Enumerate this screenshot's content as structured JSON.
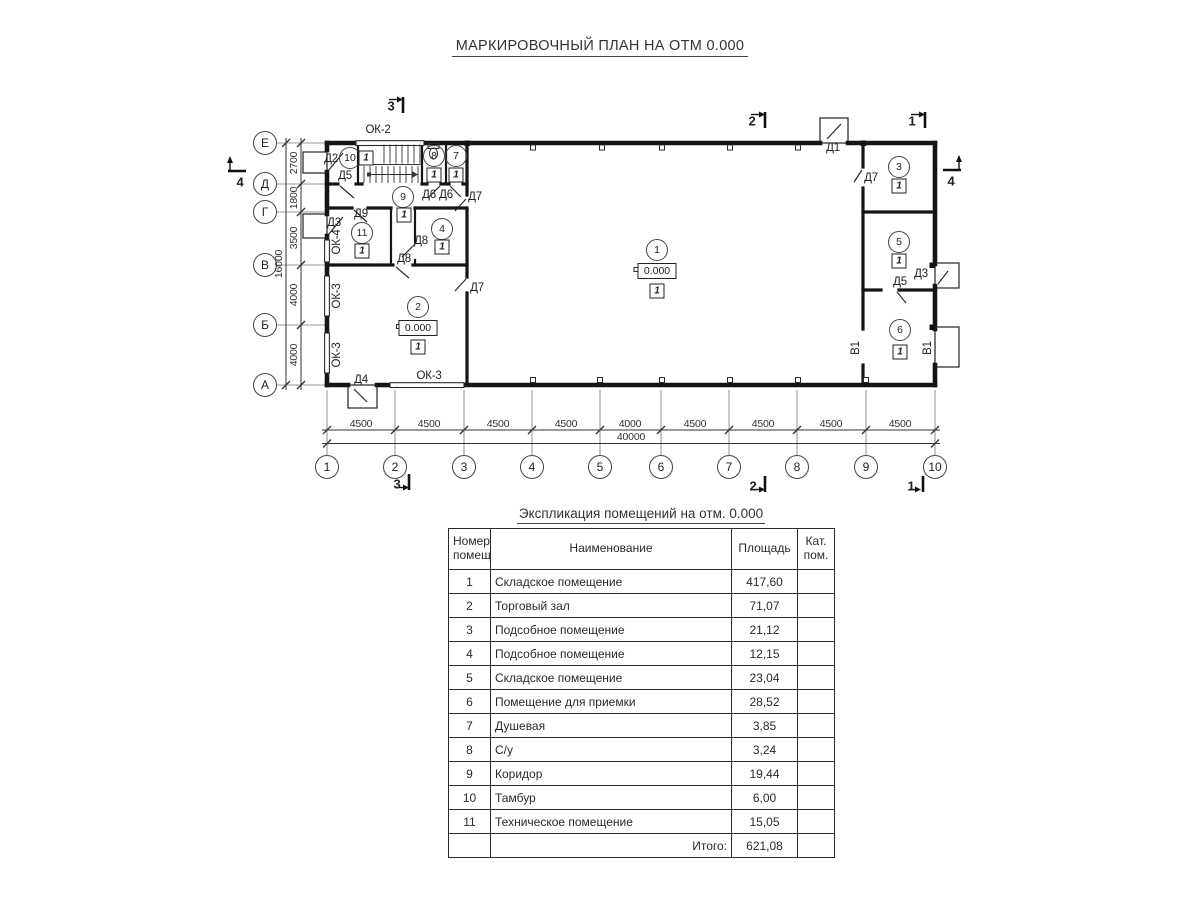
{
  "title": "МАРКИРОВОЧНЫЙ ПЛАН НА ОТМ 0.000",
  "plan": {
    "col_axes": [
      {
        "label": "1",
        "x": 327
      },
      {
        "label": "2",
        "x": 395
      },
      {
        "label": "3",
        "x": 464
      },
      {
        "label": "4",
        "x": 532
      },
      {
        "label": "5",
        "x": 600
      },
      {
        "label": "6",
        "x": 661
      },
      {
        "label": "7",
        "x": 729
      },
      {
        "label": "8",
        "x": 797
      },
      {
        "label": "9",
        "x": 866
      },
      {
        "label": "10",
        "x": 935
      }
    ],
    "row_axes": [
      {
        "label": "Е",
        "y": 143
      },
      {
        "label": "Д",
        "y": 184
      },
      {
        "label": "Г",
        "y": 212
      },
      {
        "label": "В",
        "y": 265
      },
      {
        "label": "Б",
        "y": 325
      },
      {
        "label": "А",
        "y": 385
      }
    ],
    "dims_bottom": [
      {
        "v": "4500",
        "x": 361
      },
      {
        "v": "4500",
        "x": 429
      },
      {
        "v": "4500",
        "x": 498
      },
      {
        "v": "4500",
        "x": 566
      },
      {
        "v": "4000",
        "x": 630
      },
      {
        "v": "4500",
        "x": 695
      },
      {
        "v": "4500",
        "x": 763
      },
      {
        "v": "4500",
        "x": 831
      },
      {
        "v": "4500",
        "x": 900
      }
    ],
    "total_bottom": {
      "v": "40000",
      "x": 631,
      "y": 437
    },
    "dims_left": [
      {
        "v": "2700",
        "y": 163
      },
      {
        "v": "1800",
        "y": 198
      },
      {
        "v": "3500",
        "y": 238
      },
      {
        "v": "4000",
        "y": 295
      },
      {
        "v": "4000",
        "y": 355
      }
    ],
    "total_left": {
      "v": "16000",
      "x": 279,
      "y": 264
    },
    "rooms": [
      {
        "n": "1",
        "cx": 657,
        "cy": 250,
        "elev": "0.000",
        "ex": 657,
        "ey": 271,
        "floor": "1",
        "fx": 657,
        "fy": 291
      },
      {
        "n": "2",
        "cx": 418,
        "cy": 307,
        "elev": "0.000",
        "ex": 418,
        "ey": 328,
        "floor": "1",
        "fx": 418,
        "fy": 347
      },
      {
        "n": "3",
        "cx": 899,
        "cy": 167,
        "floor": "1",
        "fx": 899,
        "fy": 186
      },
      {
        "n": "4",
        "cx": 442,
        "cy": 229,
        "floor": "1",
        "fx": 442,
        "fy": 247
      },
      {
        "n": "5",
        "cx": 899,
        "cy": 242,
        "floor": "1",
        "fx": 899,
        "fy": 261
      },
      {
        "n": "6",
        "cx": 900,
        "cy": 330,
        "floor": "1",
        "fx": 900,
        "fy": 352
      },
      {
        "n": "7",
        "cx": 456,
        "cy": 156,
        "floor": "1",
        "fx": 456,
        "fy": 175
      },
      {
        "n": "8",
        "cx": 434,
        "cy": 156,
        "floor": "1",
        "fx": 434,
        "fy": 175
      },
      {
        "n": "9",
        "cx": 403,
        "cy": 197,
        "floor": "1",
        "fx": 404,
        "fy": 215
      },
      {
        "n": "10",
        "cx": 350,
        "cy": 158,
        "floor": "1",
        "fx": 366,
        "fy": 158
      },
      {
        "n": "11",
        "cx": 362,
        "cy": 233,
        "floor": "1",
        "fx": 362,
        "fy": 251
      }
    ],
    "doors": [
      {
        "id": "Д1",
        "x": 833,
        "y": 148
      },
      {
        "id": "Д2",
        "x": 331,
        "y": 159
      },
      {
        "id": "Д3",
        "x": 334,
        "y": 223
      },
      {
        "id": "Д3",
        "x": 921,
        "y": 274
      },
      {
        "id": "Д4",
        "x": 361,
        "y": 380
      },
      {
        "id": "Д5",
        "x": 345,
        "y": 176
      },
      {
        "id": "Д5",
        "x": 900,
        "y": 282
      },
      {
        "id": "Д6",
        "x": 429,
        "y": 195
      },
      {
        "id": "Д6",
        "x": 446,
        "y": 195
      },
      {
        "id": "Д7",
        "x": 475,
        "y": 197
      },
      {
        "id": "Д7",
        "x": 477,
        "y": 288
      },
      {
        "id": "Д7",
        "x": 871,
        "y": 178
      },
      {
        "id": "Д8",
        "x": 421,
        "y": 241
      },
      {
        "id": "Д8",
        "x": 404,
        "y": 259
      },
      {
        "id": "Д9",
        "x": 361,
        "y": 214
      }
    ],
    "windows": [
      {
        "id": "ОК-2",
        "x": 378,
        "y": 130,
        "rot": 0
      },
      {
        "id": "ОК-4",
        "x": 337,
        "y": 242,
        "rot": 1
      },
      {
        "id": "ОК-3",
        "x": 337,
        "y": 296,
        "rot": 1
      },
      {
        "id": "ОК-3",
        "x": 337,
        "y": 355,
        "rot": 1
      },
      {
        "id": "ОК-3",
        "x": 429,
        "y": 376,
        "rot": 0
      }
    ],
    "gates": [
      {
        "id": "В1",
        "x": 856,
        "y": 348,
        "rot": 1
      },
      {
        "id": "В1",
        "x": 928,
        "y": 348,
        "rot": 1
      }
    ],
    "sections": [
      {
        "n": "3",
        "x": 391,
        "y": 106
      },
      {
        "n": "2",
        "x": 752,
        "y": 121
      },
      {
        "n": "1",
        "x": 912,
        "y": 121
      },
      {
        "n": "4",
        "x": 240,
        "y": 182
      },
      {
        "n": "4",
        "x": 951,
        "y": 181
      },
      {
        "n": "3",
        "x": 397,
        "y": 484
      },
      {
        "n": "2",
        "x": 753,
        "y": 486
      },
      {
        "n": "1",
        "x": 911,
        "y": 486
      }
    ]
  },
  "table": {
    "title": "Экспликация помещений на отм. 0.000",
    "headers": {
      "num": "Номер помещ.",
      "name": "Наименование",
      "area": "Площадь",
      "cat": "Кат. пом."
    },
    "rows": [
      {
        "num": "1",
        "name": "Складское помещение",
        "area": "417,60",
        "cat": ""
      },
      {
        "num": "2",
        "name": "Торговый зал",
        "area": "71,07",
        "cat": ""
      },
      {
        "num": "3",
        "name": "Подсобное помещение",
        "area": "21,12",
        "cat": ""
      },
      {
        "num": "4",
        "name": "Подсобное помещение",
        "area": "12,15",
        "cat": ""
      },
      {
        "num": "5",
        "name": "Складское помещение",
        "area": "23,04",
        "cat": ""
      },
      {
        "num": "6",
        "name": "Помещение для приемки",
        "area": "28,52",
        "cat": ""
      },
      {
        "num": "7",
        "name": "Душевая",
        "area": "3,85",
        "cat": ""
      },
      {
        "num": "8",
        "name": "С/у",
        "area": "3,24",
        "cat": ""
      },
      {
        "num": "9",
        "name": "Коридор",
        "area": "19,44",
        "cat": ""
      },
      {
        "num": "10",
        "name": "Тамбур",
        "area": "6,00",
        "cat": ""
      },
      {
        "num": "11",
        "name": "Техническое помещение",
        "area": "15,05",
        "cat": ""
      }
    ],
    "total_label": "Итого:",
    "total_value": "621,08"
  }
}
